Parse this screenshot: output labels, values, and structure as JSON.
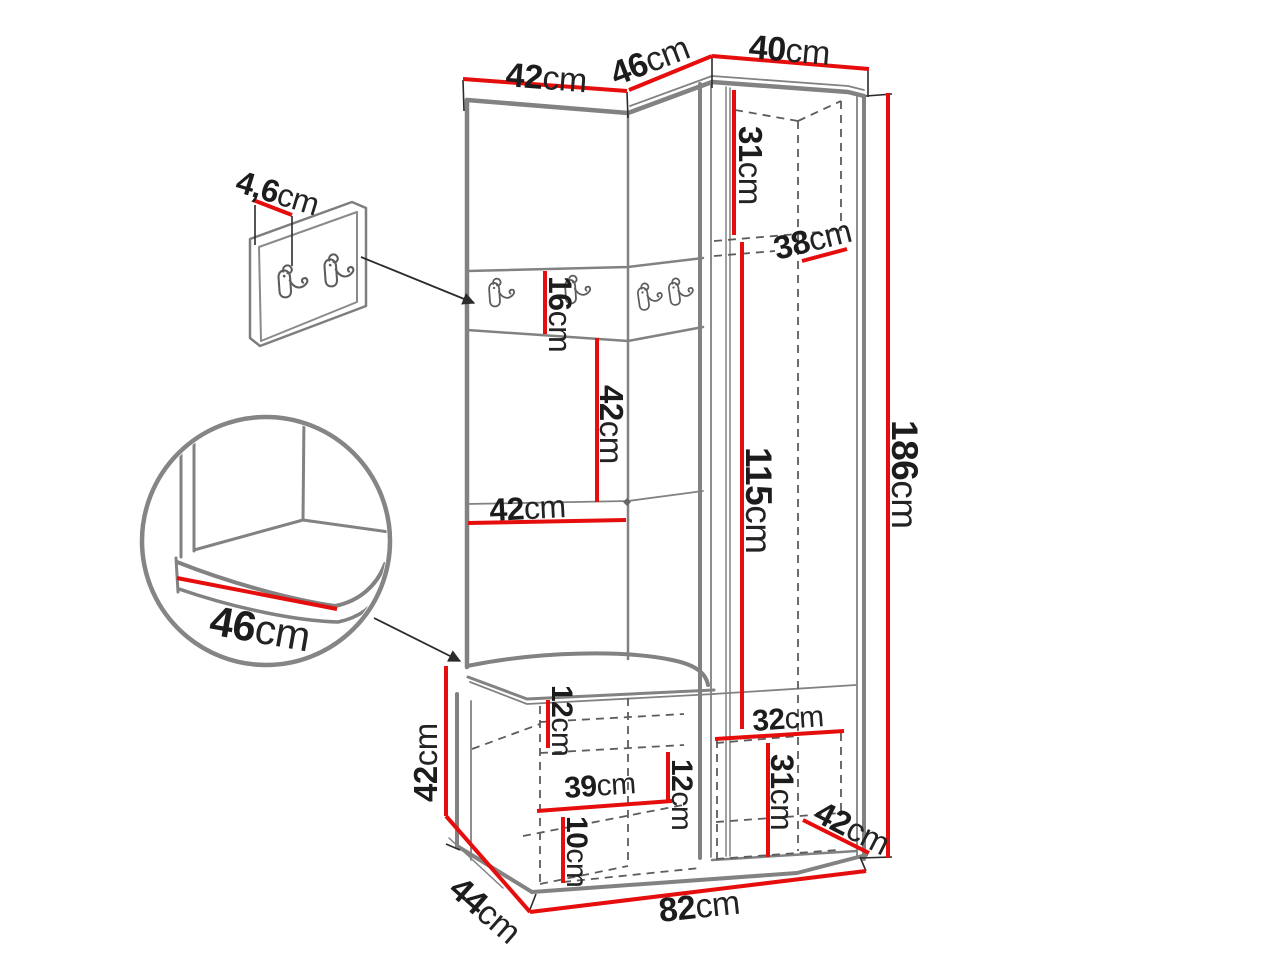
{
  "diagram": {
    "description": "Hallway furniture set dimension drawing: tall upholstered coat panel with hook rails, corner cabinet and storage bench, plus wall hook panel detail and seat corner zoom detail",
    "colors": {
      "dimension_red": "#e60d0d",
      "outline_gray": "#828282",
      "label_dark": "#1c1c1c",
      "background": "#ffffff"
    },
    "labels": {
      "top_width_left": {
        "value": "42",
        "unit": "cm"
      },
      "top_width_corner": {
        "value": "46",
        "unit": "cm"
      },
      "top_width_right": {
        "value": "40",
        "unit": "cm"
      },
      "panel_thickness": {
        "value": "4,6",
        "unit": "cm"
      },
      "hook_strip_height": {
        "value": "16",
        "unit": "cm"
      },
      "top_inner_height": {
        "value": "31",
        "unit": "cm"
      },
      "inner_depth": {
        "value": "38",
        "unit": "cm"
      },
      "mid_panel_height": {
        "value": "42",
        "unit": "cm"
      },
      "mid_panel_width": {
        "value": "42",
        "unit": "cm"
      },
      "door_inner_height": {
        "value": "115",
        "unit": "cm"
      },
      "total_height": {
        "value": "186",
        "unit": "cm"
      },
      "seat_depth": {
        "value": "46",
        "unit": "cm"
      },
      "bench_height": {
        "value": "42",
        "unit": "cm"
      },
      "bench_depth": {
        "value": "44",
        "unit": "cm"
      },
      "bench_width": {
        "value": "82",
        "unit": "cm"
      },
      "bench_inner_top": {
        "value": "12",
        "unit": "cm"
      },
      "bench_inner_width": {
        "value": "39",
        "unit": "cm"
      },
      "bench_inner_mid": {
        "value": "12",
        "unit": "cm"
      },
      "bench_inner_bottom": {
        "value": "10",
        "unit": "cm"
      },
      "cabinet_inner_width": {
        "value": "32",
        "unit": "cm"
      },
      "cabinet_inner_bottom_height": {
        "value": "31",
        "unit": "cm"
      },
      "cabinet_bottom_depth": {
        "value": "42",
        "unit": "cm"
      }
    }
  }
}
